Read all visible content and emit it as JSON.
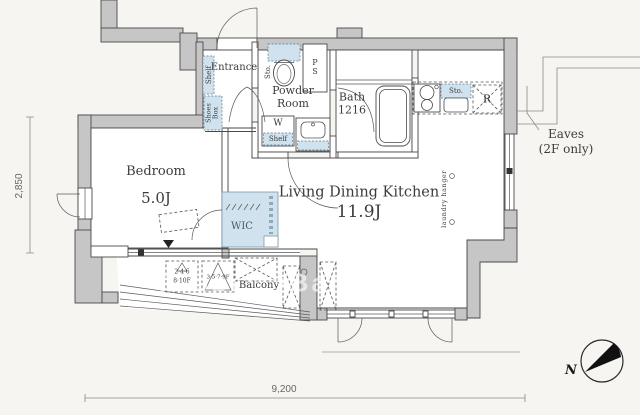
{
  "plan": {
    "rooms": {
      "entrance": {
        "label": "Entrance"
      },
      "powder": {
        "label": "Powder Room"
      },
      "bath": {
        "label": "Bath",
        "size": "1216"
      },
      "bedroom": {
        "label": "Bedroom",
        "size": "5.0J"
      },
      "ldk": {
        "label": "Living Dining Kitchen",
        "size": "11.9J"
      },
      "wic": {
        "label": "WIC"
      },
      "balcony": {
        "label": "Balcony"
      }
    },
    "fixtures": {
      "entrance_shelf": "Shelf",
      "shoes_box": "Shoes Box",
      "toilet_storage": "Sto.",
      "pipe_space": "PS",
      "washer": "W",
      "washer_shelf": "Shelf",
      "kitchen_storage": "Sto.",
      "refrigerator": "R",
      "laundry_hanger": "laundry hanger"
    },
    "notes": {
      "eaves_line1": "Eaves",
      "eaves_line2": "(2F only)",
      "partition_a_line1": "2·4·6",
      "partition_a_line2": "8·10F",
      "partition_b": "3·5·7·9F",
      "north": "N",
      "watermark": "PropertyBank"
    },
    "dimensions": {
      "horizontal": "9,200",
      "vertical": "2,850"
    },
    "colors": {
      "wall": "#c6c6c6",
      "fixture_blue": "#cfe2ee"
    }
  }
}
